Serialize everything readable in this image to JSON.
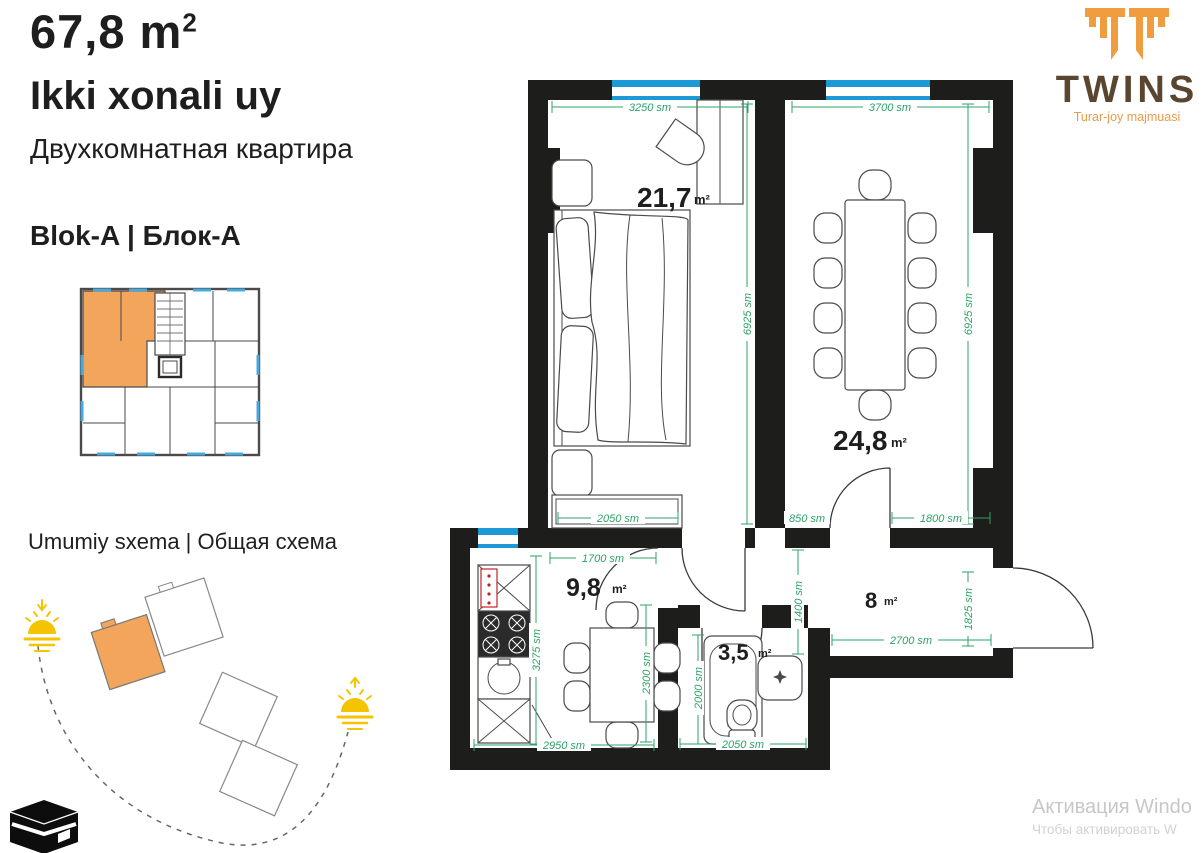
{
  "header": {
    "area_main": "67,8 m",
    "area_sup": "2",
    "title_uz": "Ikki xonali uy",
    "title_ru": "Двухкомнатная квартира",
    "block_label": "Blok-A | Блок-А",
    "scheme_label": "Umumiy sxema | Общая схема"
  },
  "logo": {
    "brand": "TWINS",
    "tagline": "Turar-joy majmuasi"
  },
  "floorplan": {
    "rooms": {
      "bedroom": {
        "area": "21,7",
        "unit": "m²"
      },
      "living": {
        "area": "24,8",
        "unit": "m²"
      },
      "kitchen": {
        "area": "9,8",
        "unit": "m²"
      },
      "bathroom": {
        "area": "3,5",
        "unit": "m²"
      },
      "hallway": {
        "area": "8",
        "unit": "m²"
      }
    },
    "dims": {
      "bedroom_width": "3250 sm",
      "living_width": "3700 sm",
      "bedroom_height": "6925 sm",
      "living_height": "6925 sm",
      "dresser": "2050 sm",
      "living_door_offset": "850 sm",
      "living_bottom": "1800 sm",
      "kitchen_top": "1700 sm",
      "corridor": "1400 sm",
      "counter": "3275 sm",
      "kitchen_height": "2300 sm",
      "kitchen_bottom": "2950 sm",
      "bathtub": "2000 sm",
      "bathroom_bottom": "2050 sm",
      "hallway_bottom": "2700 sm",
      "entry": "1825 sm"
    }
  },
  "watermark": {
    "line1": "Активация Windo",
    "line2": "Чтобы активировать W"
  },
  "colors": {
    "accent_orange": "#F2A55B",
    "dim_green": "#2BA366",
    "window_blue": "#1B9AD6",
    "wall_black": "#1D1D1B",
    "logo_brown": "#5A452F",
    "logo_orange": "#EF9D3F"
  }
}
